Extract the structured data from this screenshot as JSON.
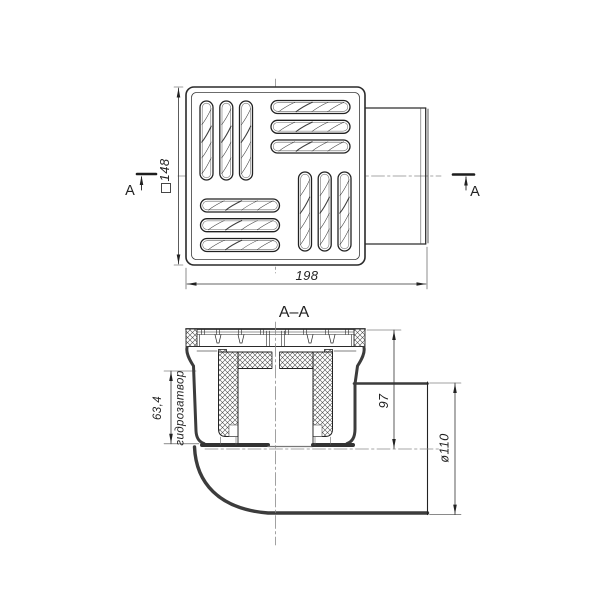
{
  "drawing": {
    "section_title": "A–A",
    "section_mark_left": "A",
    "section_mark_right": "A",
    "dimensions": {
      "grate_width": "148",
      "overall_length": "198",
      "axis_height": "97",
      "seal_height": "63,4",
      "seal_label": "гидрозатвор",
      "outlet_diameter": "ø110"
    },
    "colors": {
      "background": "#ffffff",
      "line": "#2f2f2f",
      "centerline": "#8a8a8a"
    }
  }
}
